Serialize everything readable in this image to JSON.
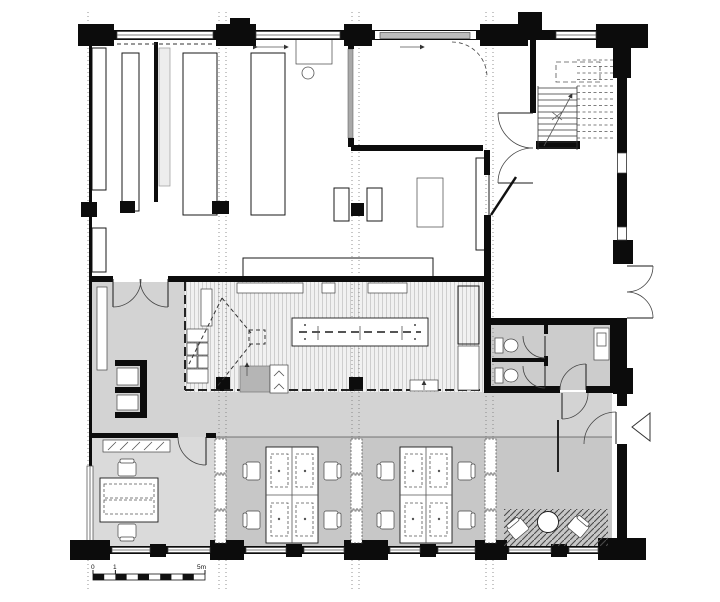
{
  "drawing": {
    "kind": "architectural floor plan, single storey",
    "scale_bar": {
      "start_label": "0",
      "mid_label": "1",
      "end_label": "5m"
    }
  },
  "colors": {
    "background": "#ffffff",
    "wall": "#0c0c0c",
    "circulation_floor": "#d3d3d3",
    "open_office_floor": "#c7c7c7",
    "left_office_floor": "#dadada",
    "wc_floor": "#cccccc",
    "workshop_floor": "#f1f1f1",
    "counter": "#b5b5b5",
    "partition_gray": "#a9a9a9"
  }
}
